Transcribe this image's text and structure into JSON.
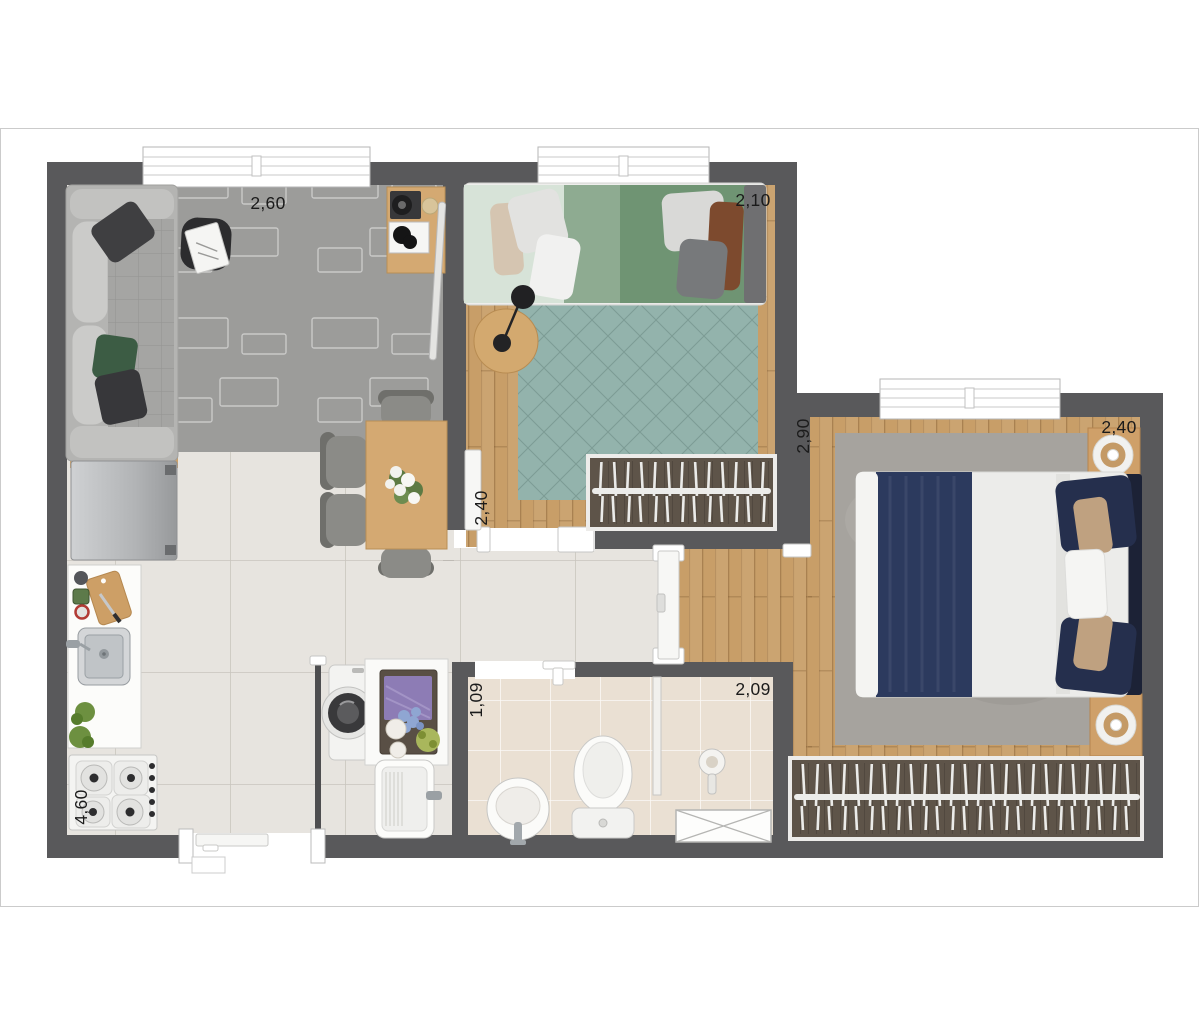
{
  "plan": {
    "dimensions": {
      "living_width": "2,60",
      "bedroom1_width": "2,10",
      "bedroom1_depth": "2,40",
      "bedroom2_width": "2,40",
      "bedroom2_depth": "2,90",
      "bathroom_depth": "1,09",
      "bathroom_width": "2,09",
      "kitchen_depth": "4,60"
    },
    "palette": {
      "wall": "#59595b",
      "tile_floor": "#e7e4df",
      "wood_floor": "#c89e68",
      "bath_tile": "#eae0d3",
      "rug_living": "#9c9c9a",
      "rug_bedroom1": "#93b3ac",
      "rug_bedroom2": "#a6a39e",
      "wardrobe_interior": "#5e5449",
      "furniture_wood": "#d4a972",
      "bed_navy": "#2c3a5e",
      "bed_green": "#6f9473"
    }
  }
}
